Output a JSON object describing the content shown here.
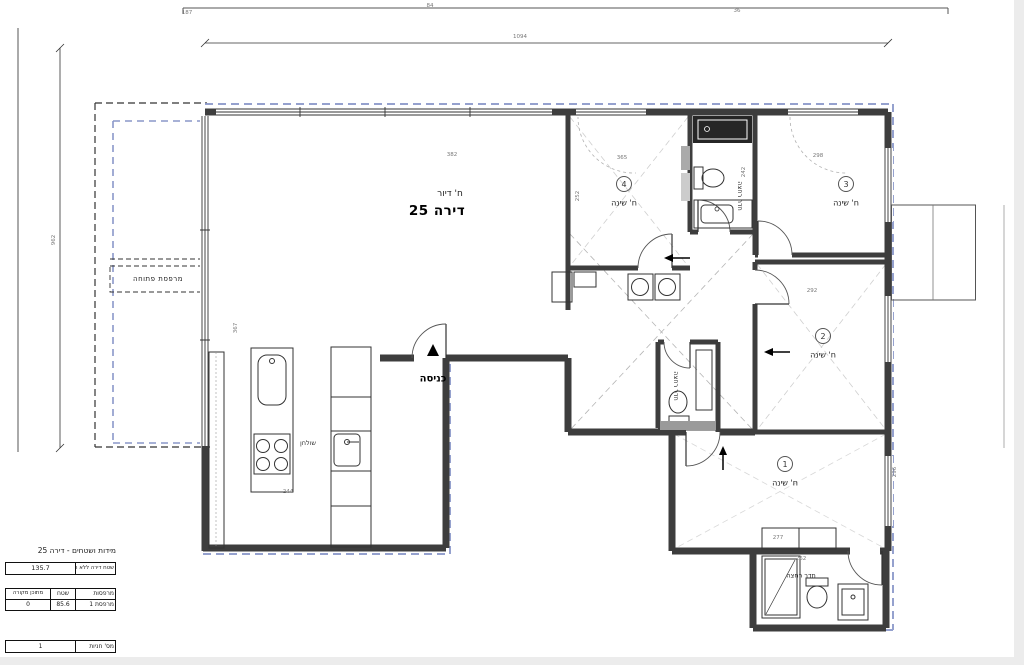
{
  "plan": {
    "apartment": {
      "room_type": "ח' דיור",
      "unit": "דירה 25"
    },
    "entry": {
      "label": "כניסה"
    },
    "kitchen": {
      "table_label": "שולחן"
    },
    "balcony": {
      "label": "מרפסת פתוחה"
    },
    "bedrooms": [
      {
        "num": "4",
        "label": "ח' שינה",
        "x": 624,
        "y": 184
      },
      {
        "num": "3",
        "label": "ח' שינה",
        "x": 846,
        "y": 184
      },
      {
        "num": "2",
        "label": "ח' שינה",
        "x": 823,
        "y": 336
      },
      {
        "num": "1",
        "label": "ח' שינה",
        "x": 785,
        "y": 464
      }
    ],
    "bath_labels": [
      {
        "text": "חדר רחצה",
        "x": 740,
        "y": 196,
        "rot": 90,
        "w": 0
      },
      {
        "text": "חדר רחצה",
        "x": 676,
        "y": 386,
        "rot": 90,
        "w": 0
      },
      {
        "text": "חדר רחצה",
        "x": 801,
        "y": 576,
        "rot": 0,
        "w": 30
      }
    ],
    "dimensions": [
      {
        "t": "1094",
        "x": 520,
        "y": 37,
        "r": 0
      },
      {
        "t": "962",
        "x": 54,
        "y": 240,
        "r": -90
      },
      {
        "t": "187",
        "x": 187,
        "y": 13,
        "r": 0
      },
      {
        "t": "84",
        "x": 430,
        "y": 6,
        "r": 0
      },
      {
        "t": "36",
        "x": 737,
        "y": 11,
        "r": 0
      },
      {
        "t": "382",
        "x": 452,
        "y": 155,
        "r": 0
      },
      {
        "t": "365",
        "x": 622,
        "y": 158,
        "r": 0
      },
      {
        "t": "298",
        "x": 818,
        "y": 156,
        "r": 0
      },
      {
        "t": "252",
        "x": 578,
        "y": 196,
        "r": -90
      },
      {
        "t": "242",
        "x": 744,
        "y": 172,
        "r": -90
      },
      {
        "t": "367",
        "x": 236,
        "y": 328,
        "r": -90
      },
      {
        "t": "292",
        "x": 812,
        "y": 291,
        "r": 0
      },
      {
        "t": "296",
        "x": 895,
        "y": 472,
        "r": -90
      },
      {
        "t": "277",
        "x": 778,
        "y": 538,
        "r": 0
      },
      {
        "t": "262",
        "x": 801,
        "y": 559,
        "r": 0
      },
      {
        "t": "244",
        "x": 288,
        "y": 492,
        "r": 0
      }
    ],
    "colors": {
      "wall": "#3d3d3d",
      "blue_dash": "#8a97c9",
      "line": "#333333"
    }
  },
  "panel": {
    "title": "מידות ושטחים - דירה 25",
    "apartment_area": {
      "label": "שטח דירה ללא המרפסת",
      "value": "135.7"
    },
    "balconies": {
      "col_name": "מרפסות",
      "col_area": "שטח",
      "col_covered": "מתוכן מקורה",
      "row_name": "מרפסת 1",
      "row_area": "85.6",
      "row_covered": "0"
    },
    "parking": {
      "label": "מס' חניות",
      "value": "1"
    }
  }
}
